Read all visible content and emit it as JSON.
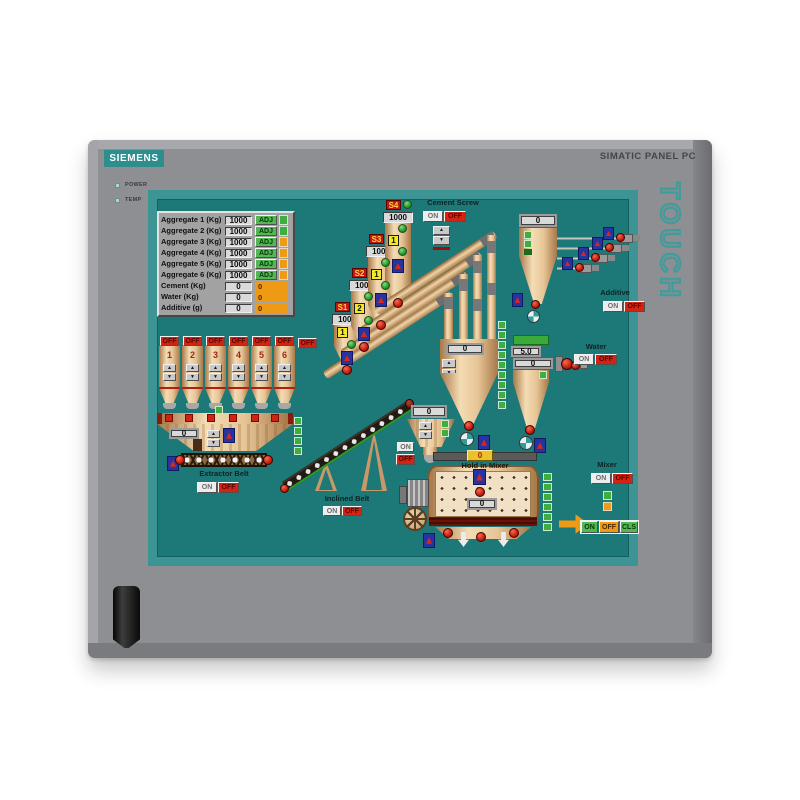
{
  "panel": {
    "brand": "SIEMENS",
    "model": "SIMATIC PANEL PC",
    "touch": "TOUCH",
    "leds": [
      "POWER",
      "TEMP"
    ]
  },
  "icons": {
    "up": "▲",
    "down": "▼"
  },
  "recipe_table": {
    "rows": [
      {
        "label": "Aggregate 1 (Kg)",
        "value": "1000",
        "button": "ADJ"
      },
      {
        "label": "Aggregate 2 (Kg)",
        "value": "1000",
        "button": "ADJ"
      },
      {
        "label": "Aggregate 3 (Kg)",
        "value": "1000",
        "button": "ADJ"
      },
      {
        "label": "Aggregate 4 (Kg)",
        "value": "1000",
        "button": "ADJ"
      },
      {
        "label": "Aggregate 5 (Kg)",
        "value": "1000",
        "button": "ADJ"
      },
      {
        "label": "Aggregate 6 (Kg)",
        "value": "1000",
        "button": "ADJ"
      },
      {
        "label": "Cement (Kg)",
        "value": "0",
        "aux": "0"
      },
      {
        "label": "Water (Kg)",
        "value": "0",
        "aux": "0"
      },
      {
        "label": "Additive (g)",
        "value": "0",
        "aux": "0"
      }
    ]
  },
  "aggregate_silos": {
    "off": "OFF",
    "numbers": [
      "1",
      "2",
      "3",
      "4",
      "5",
      "6"
    ]
  },
  "aggregate_weigher": {
    "value": "0"
  },
  "extractor_belt": {
    "label": "Extractor Belt",
    "on": "ON",
    "off": "OFF"
  },
  "cement_silos": [
    {
      "id": "S1",
      "value": "1000",
      "badge": "1"
    },
    {
      "id": "S2",
      "value": "1000",
      "badge": "2"
    },
    {
      "id": "S3",
      "value": "1000",
      "badge": "1"
    },
    {
      "id": "S4",
      "value": "1000",
      "badge": "1"
    }
  ],
  "cement_screw": {
    "label": "Cement Screw",
    "on": "ON",
    "off": "OFF"
  },
  "cement_weigher": {
    "value": "0"
  },
  "additive": {
    "label": "Additive",
    "on": "ON",
    "off": "OFF",
    "value": "0"
  },
  "water": {
    "label": "Water",
    "on": "ON",
    "off": "OFF",
    "setpoint": "5.0",
    "value": "0"
  },
  "inclined_belt": {
    "label": "Inclined Belt",
    "on": "ON",
    "off": "OFF"
  },
  "transfer_hopper": {
    "value": "0",
    "on": "ON",
    "off": "OFF"
  },
  "mixer": {
    "label": "Mixer",
    "hold_label": "Hold in Mixer",
    "top_value": "0",
    "value": "0",
    "on": "ON",
    "off": "OFF",
    "discharge_on": "ON",
    "discharge_off": "OFF",
    "discharge_cls": "CLS"
  }
}
